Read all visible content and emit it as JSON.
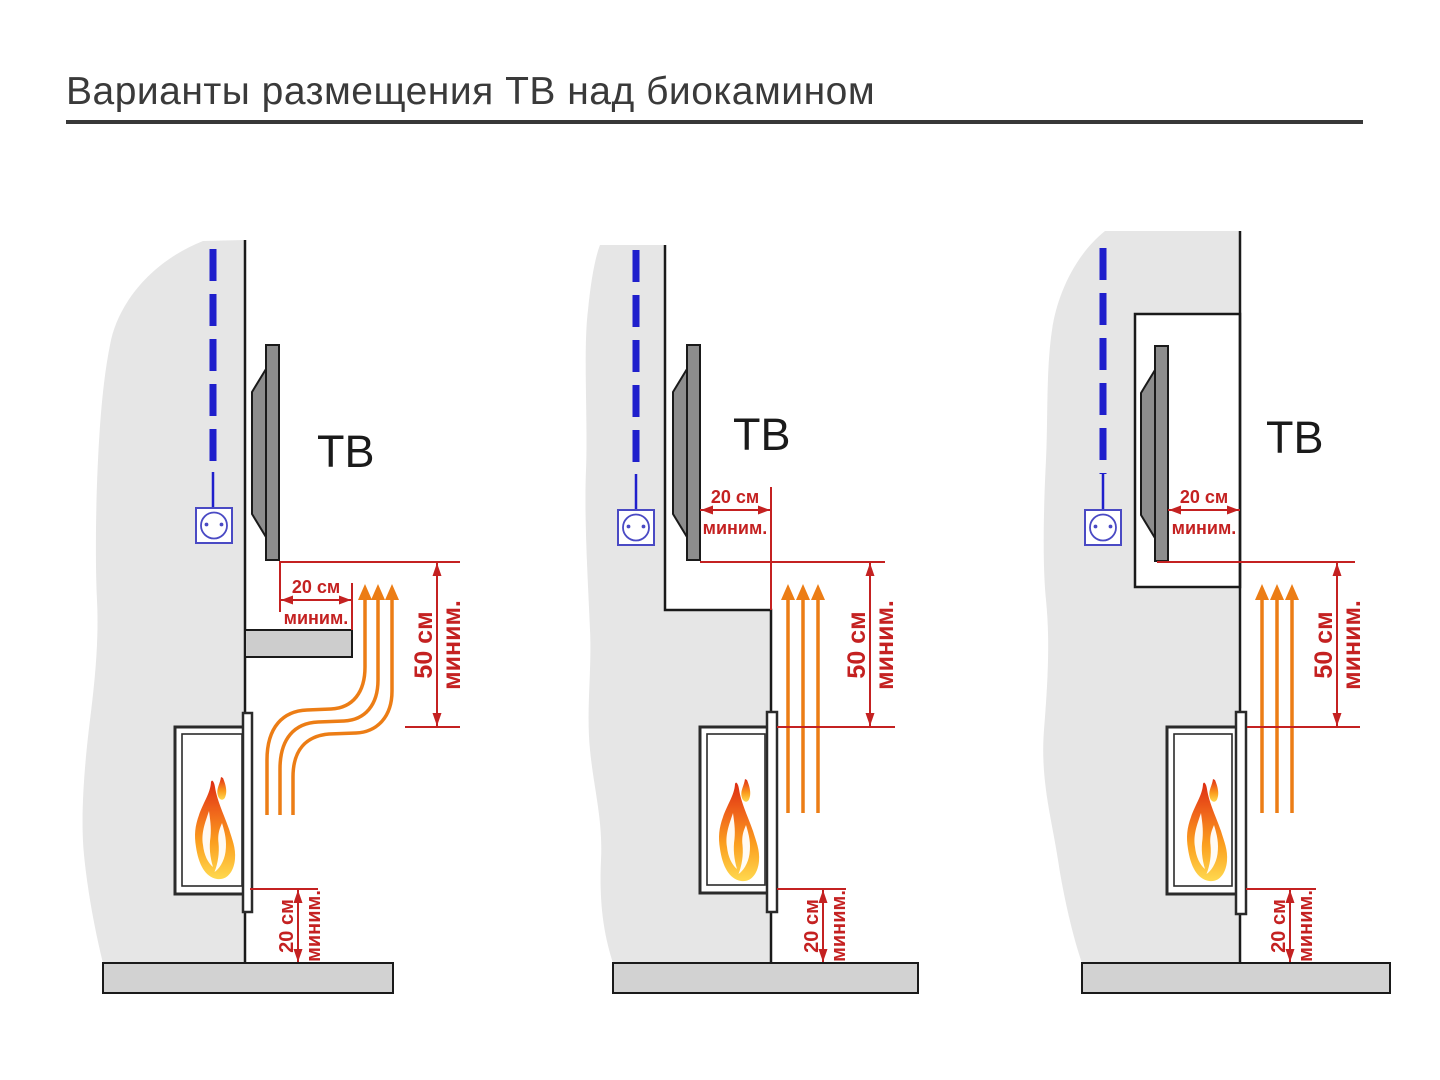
{
  "title": "Варианты размещения ТВ над биокамином",
  "colors": {
    "dimension_red": "#c42121",
    "heat_arrow_orange": "#ec7d15",
    "cable_blue": "#1f1fcc",
    "outlet_blue": "#4a4ac4",
    "wall_gray": "#e6e6e6",
    "floor_gray": "#d2d2d2",
    "tv_gray": "#8d8d8d",
    "flame_top": "#dd2d12",
    "flame_bottom": "#ffd94f"
  },
  "diagrams": [
    {
      "variant": "tv-above-shelf",
      "tv_label": "ТВ",
      "dim_clearance_front": {
        "value": "20 см",
        "qualifier": "миним."
      },
      "dim_height_above": {
        "value": "50 см",
        "qualifier": "миним."
      },
      "dim_floor": {
        "value": "20 см",
        "qualifier": "миним."
      }
    },
    {
      "variant": "tv-recessed-wall-step",
      "tv_label": "ТВ",
      "dim_clearance_front": {
        "value": "20 см",
        "qualifier": "миним."
      },
      "dim_height_above": {
        "value": "50 см",
        "qualifier": "миним."
      },
      "dim_floor": {
        "value": "20 см",
        "qualifier": "миним."
      }
    },
    {
      "variant": "tv-in-niche",
      "tv_label": "ТВ",
      "dim_clearance_front": {
        "value": "20 см",
        "qualifier": "миним."
      },
      "dim_height_above": {
        "value": "50 см",
        "qualifier": "миним."
      },
      "dim_floor": {
        "value": "20 см",
        "qualifier": "миним."
      }
    }
  ]
}
